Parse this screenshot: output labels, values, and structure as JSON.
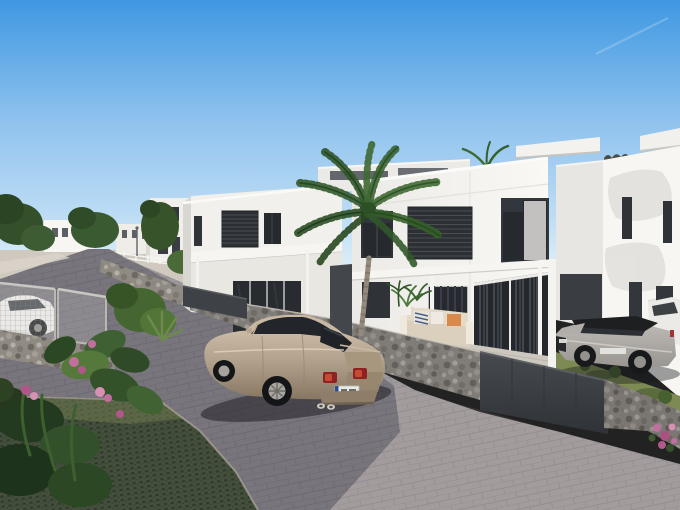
{
  "scene": {
    "alt": "Architectural 3D render of a modern white villa development on a hillside: two-storey flat-roof houses with dark windows, a tall palm tree, gabion stone walls and dark metal fences along a curving grey paver street, a champagne sedan parked on the road, a silver SUV with black roof parked on the lawn to the right, lush green plants with pink flowers and a white mesh gate with a white car behind it on the left, under a clear blue sky.",
    "elements": [
      {
        "name": "sky",
        "desc": "clear blue sky, pale at horizon, faint contrail top right"
      },
      {
        "name": "distant-buildings",
        "desc": "low white houses on the left horizon among dark green trees"
      },
      {
        "name": "road",
        "desc": "grey block-paver street curving downhill from upper left to foreground"
      },
      {
        "name": "grass-paver-parking",
        "desc": "dark green grass-grid parking surface, bottom left"
      },
      {
        "name": "house-left",
        "desc": "white two-storey house with louvered windows and glass doors"
      },
      {
        "name": "house-main",
        "desc": "large white villa with louvered and glass windows, pergola and terrace"
      },
      {
        "name": "house-right",
        "desc": "sunlit white house with narrow slit windows and tree shadows"
      },
      {
        "name": "palm-tree",
        "desc": "tall palm in front of the villas"
      },
      {
        "name": "gabion-walls",
        "desc": "stone-filled gabion retaining walls along the street"
      },
      {
        "name": "dark-fence",
        "desc": "dark grey metal fence panels"
      },
      {
        "name": "outdoor-sofa",
        "desc": "beige terrace sofa with navy striped and orange cushions"
      },
      {
        "name": "sedan-car",
        "desc": "champagne/beige sedan parked on the street, rear three-quarter view"
      },
      {
        "name": "suv-car",
        "desc": "silver SUV with black roof parked on the right lawn"
      },
      {
        "name": "white-car-left",
        "desc": "white car behind mesh gate on the left"
      },
      {
        "name": "white-car-right",
        "desc": "white car partly hidden behind the SUV at right edge"
      },
      {
        "name": "foreground-plants",
        "desc": "tropical leaves and pink flowers, lower left"
      }
    ]
  },
  "palette": {
    "sky_top": "#3f98e2",
    "sky_mid": "#8fc2ee",
    "sky_horizon": "#ddeef9",
    "house_lit": "#f7f6f3",
    "house_face": "#f1f0ec",
    "house_shade": "#d9d7d2",
    "window_dark": "#26292d",
    "louver_dark": "#2c2f33",
    "road": "#9e999b",
    "road_shadow": "#2f3040",
    "stone": "#8f8a82",
    "fence_dark": "#3e4247",
    "grass": "#7d8a53",
    "grass_paver": "#444f3d",
    "foliage_dark": "#2c4a25",
    "foliage_mid": "#3a6330",
    "flower_pink": "#c06f9e",
    "sedan_body": "#b3a28e",
    "suv_silver": "#c0bdb8",
    "suv_roof": "#1d1f21",
    "terrace": "#ccc8c0",
    "sofa": "#dbd0bd",
    "cushion_orange": "#d8894b",
    "cushion_navy": "#49618a"
  }
}
